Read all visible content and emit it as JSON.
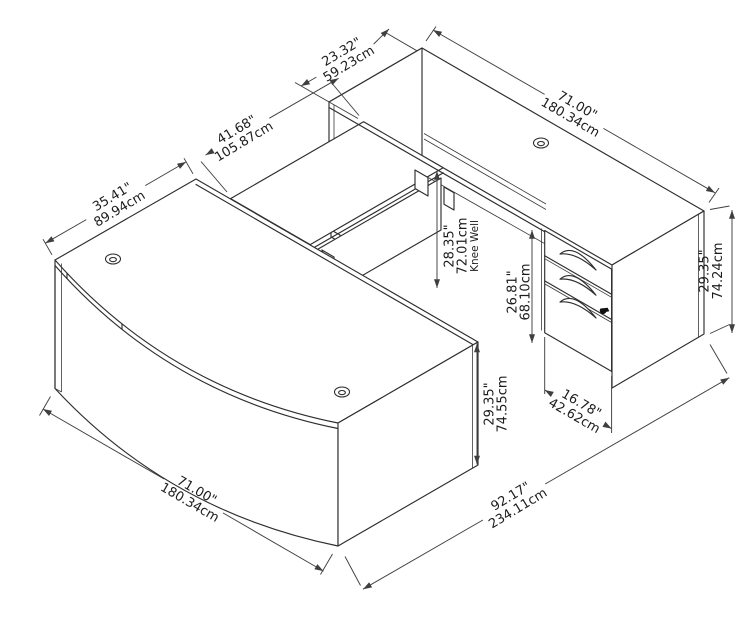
{
  "diagram": {
    "title": "U-shaped bow front desk with bridge, credenza and pedestal - dimension drawing",
    "background_color": "#ffffff",
    "line_color": "#2e2e2e",
    "dims": {
      "credenza_depth": {
        "in": "23.32\"",
        "cm": "59.23cm"
      },
      "credenza_length": {
        "in": "71.00\"",
        "cm": "180.34cm"
      },
      "bridge_length": {
        "in": "41.68\"",
        "cm": "105.87cm"
      },
      "desk_depth": {
        "in": "35.41\"",
        "cm": "89.94cm"
      },
      "knee_well": {
        "in": "28.35\"",
        "cm": "72.01cm",
        "label": "Knee Well"
      },
      "credenza_clearance": {
        "in": "26.81\"",
        "cm": "68.10cm"
      },
      "credenza_height": {
        "in": "29.35\"",
        "cm": "74.24cm"
      },
      "desk_height": {
        "in": "29.35\"",
        "cm": "74.55cm"
      },
      "desk_length": {
        "in": "71.00\"",
        "cm": "180.34cm"
      },
      "overall_depth": {
        "in": "92.17\"",
        "cm": "234.11cm"
      },
      "pedestal_width": {
        "in": "16.78\"",
        "cm": "42.62cm"
      }
    }
  }
}
